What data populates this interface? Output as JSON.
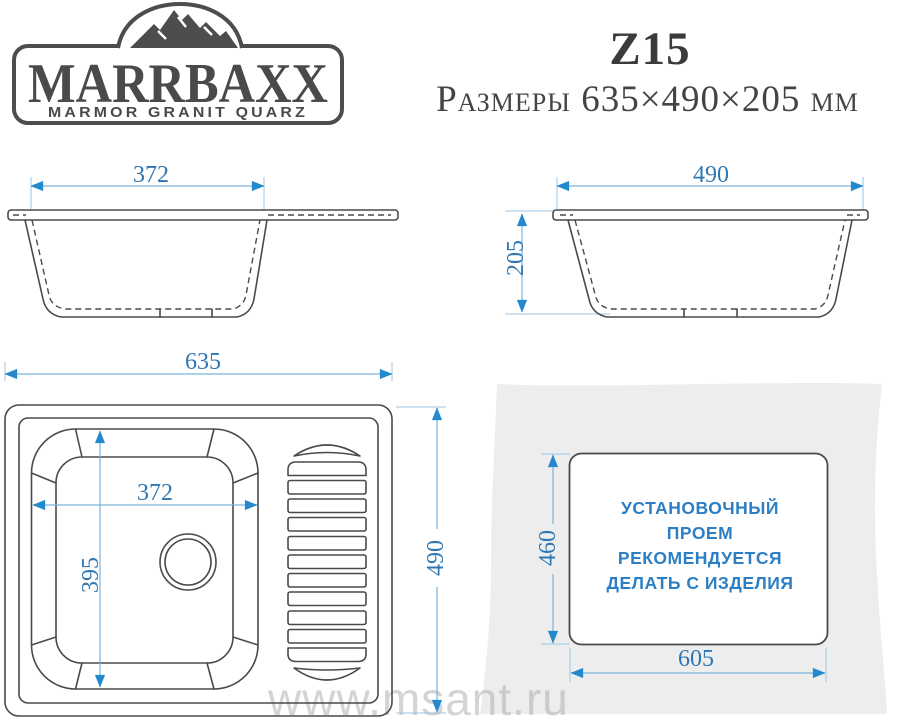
{
  "logo": {
    "brand": "MARRBAXX",
    "tagline": "MARMOR GRANIT QUARZ"
  },
  "header": {
    "model": "Z15",
    "subtitle": "Размеры 635×490×205 мм"
  },
  "views": {
    "front": {
      "bowl_width": "372"
    },
    "side": {
      "width": "490",
      "height": "205"
    },
    "top": {
      "width": "635",
      "height": "490",
      "bowl_width": "372",
      "bowl_length": "395"
    },
    "install": {
      "height": "460",
      "width": "605",
      "note_line1": "УСТАНОВОЧНЫЙ",
      "note_line2": "ПРОЕМ",
      "note_line3": "РЕКОМЕНДУЕТСЯ",
      "note_line4": "ДЕЛАТЬ С ИЗДЕЛИЯ"
    }
  },
  "watermark": "www.msant.ru",
  "colors": {
    "drawing_line": "#4a4a4a",
    "dimension_line": "#7ab4dc",
    "dimension_arrow": "#2389cc",
    "dimension_text": "#2e77b2",
    "note_text": "#2c7fc4",
    "backdrop_gray": "#ededed",
    "watermark_gray": "#aaaaaa"
  }
}
